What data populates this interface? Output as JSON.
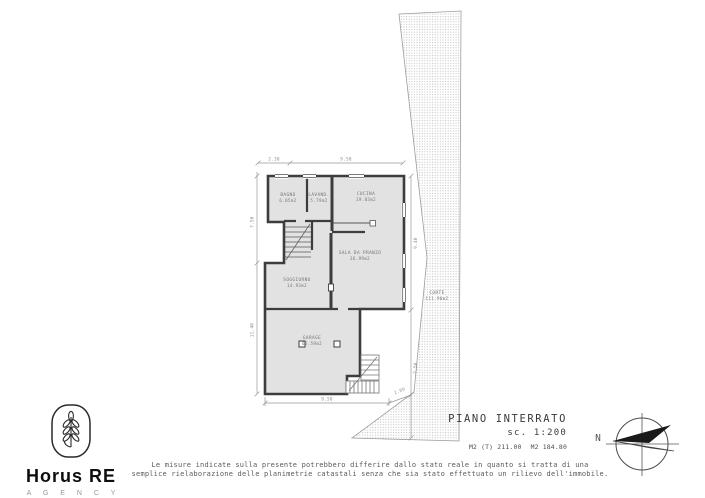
{
  "logo": {
    "brand": "Horus RE",
    "subtitle": "A G E N C Y"
  },
  "title_block": {
    "title": "PIANO INTERRATO",
    "scale": "sc. 1:200",
    "area_total": "M2 (T) 211.00",
    "area_secondary": "M2 184.80"
  },
  "compass": {
    "north": "N"
  },
  "disclaimer": {
    "line1": "Le misure indicate sulla presente potrebbero differire dallo stato reale in quanto si tratta di una",
    "line2": "semplice rielaborazione delle planimetrie catastali senza che sia stato effettuato un rilievo dell'immobile."
  },
  "plan": {
    "rooms": [
      {
        "name": "BAGNO",
        "area": "6.05m2"
      },
      {
        "name": "LAVAND.",
        "area": "5.79m2"
      },
      {
        "name": "CUCINA",
        "area": "19.03m2"
      },
      {
        "name": "SALA DA PRANZO",
        "area": "36.99m2"
      },
      {
        "name": "SOGGIORNO",
        "area": "14.93m2"
      },
      {
        "name": "GARAGE",
        "area": "62.59m2"
      },
      {
        "name": "CORTE",
        "area": "111.90m2"
      }
    ],
    "dimensions": {
      "top_left": "2.30",
      "top": "9.50",
      "left_upper": "7.50",
      "left_lower": "11.40",
      "right_upper": "9.40",
      "right_lower": "7.50",
      "bottom": "9.50",
      "bottom_right": "2.00"
    },
    "colors": {
      "wall": "#3d3d3d",
      "room_fill": "#e2e2e2",
      "dimension": "#8f8f8f",
      "label": "#757575",
      "hatch_dot": "#bdbdbd"
    }
  }
}
